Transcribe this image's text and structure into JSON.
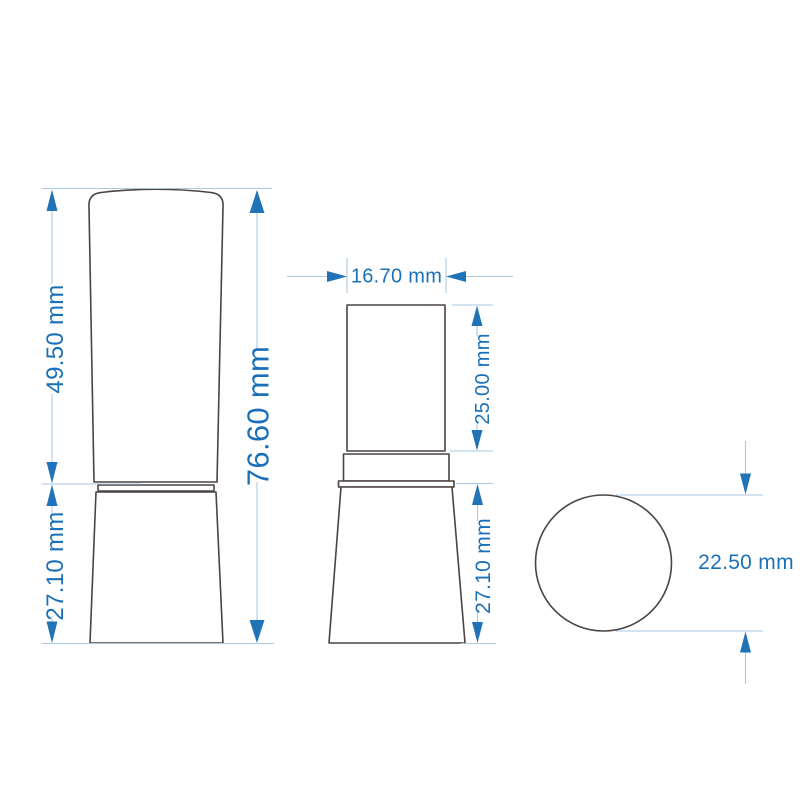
{
  "page": {
    "background": "#ffffff",
    "description": "lipstick tube technical dimension drawing"
  },
  "colors": {
    "dimension_text_blue": "#1a70b8",
    "arrow_blue": "#2173b8",
    "extension_line_blue": "#a9c8e5",
    "outline_gray": "#4a4442"
  },
  "views": {
    "front_closed": {
      "label": "closed-lipstick-front-view",
      "dim_cap_height": "49.50 mm",
      "dim_base_height": "27.10 mm",
      "dim_total_height": "76.60 mm"
    },
    "front_open": {
      "label": "open-lipstick-front-view",
      "dim_cup_width": "16.70 mm",
      "dim_cup_height": "25.00 mm",
      "dim_base_height": "27.10 mm"
    },
    "top_view": {
      "label": "tube-top-view",
      "dim_diameter": "22.50 mm"
    }
  }
}
